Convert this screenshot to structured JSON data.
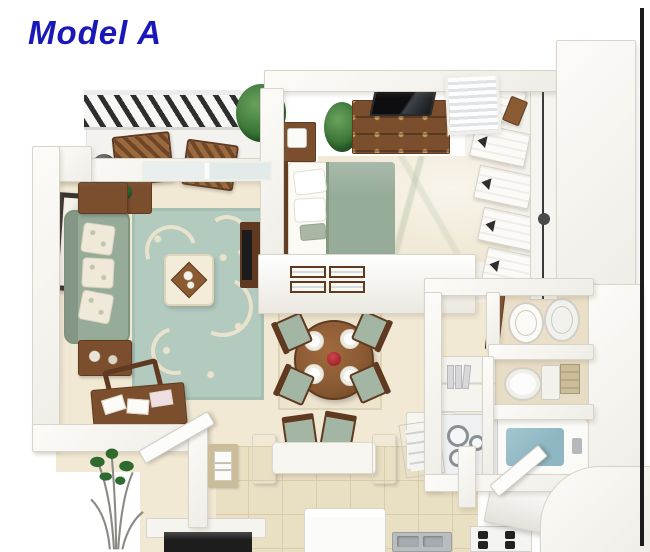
{
  "title": {
    "text": "Model A"
  },
  "palette": {
    "title_blue": "#1b18b8",
    "floor_beige": "#f1e9d3",
    "floor_tile": "#e9dfc3",
    "tile_line": "#d8cdab",
    "wall_edge": "#d8d4c9",
    "sofa_green": "#96ab98",
    "cushion_green": "#a3b6a3",
    "rug_teal": "#b3cabf",
    "rug_cream": "#e9e2cc",
    "bedroom_rug": "#f0e9d6",
    "wood_dark": "#5f3a20",
    "wood_mid": "#7b4f2e",
    "wood_light": "#8a5a33",
    "railing_dark": "#2e2e2e",
    "water_teal": "#8fb7c2",
    "plant_dark": "#2f6b2f",
    "stem_gray": "#8a8a85",
    "tv_dark": "#1b1b1b",
    "steel_gray": "#b9bdbe",
    "cream_white": "#f2ecd9",
    "towel_tan": "#cbbd9a",
    "accent_red": "#a3242c"
  },
  "scene": {
    "kind": "3d-apartment-floor-plan",
    "rooms": [
      "balcony",
      "living-room",
      "bedroom",
      "closet",
      "dining-area",
      "kitchen",
      "bathroom",
      "laundry",
      "entry"
    ]
  }
}
